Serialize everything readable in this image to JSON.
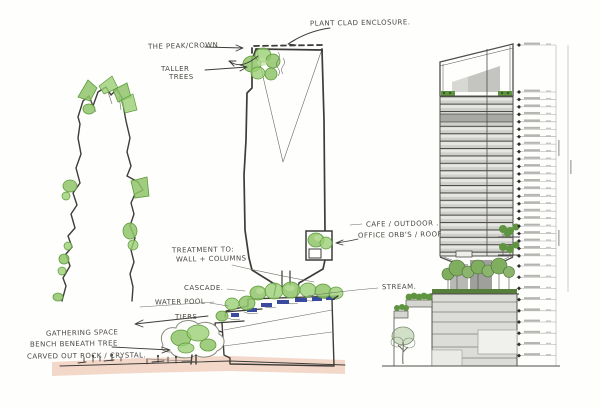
{
  "drawing": {
    "kind": "architectural concept sketch with elevation",
    "annotations": {
      "plant_clad_enclosure": "PLANT CLAD ENCLOSURE.",
      "the_peak_crown": "THE PEAK/CROWN",
      "taller_trees_line1": "TALLER",
      "taller_trees_line2": "TREES",
      "treatment_line1": "TREATMENT TO:",
      "treatment_line2": "WALL + COLUMNS",
      "cascade": "CASCADE.",
      "water_pool": "WATER POOL",
      "tiers": "TIERS",
      "stream": "STREAM.",
      "cafe_outdoor": "CAFE / OUTDOOR .",
      "office_orbs_roof": "OFFICE ORB'S / ROOF",
      "gathering_space": "GATHERING SPACE",
      "bench_beneath_tree": "BENCH BENEATH TREE",
      "carved_out_rock": "CARVED OUT ROCK / CRYSTAL."
    },
    "colors": {
      "ink": "#3e3c38",
      "foliage": "#8fc468",
      "foliage_dark": "#5d9a3a",
      "water": "#3a4a9e",
      "ground_wash": "#ecc3af",
      "elevation_grey": "#dcdcd8",
      "elevation_line": "#4e4d49",
      "elevation_green": "#5f9440"
    }
  }
}
